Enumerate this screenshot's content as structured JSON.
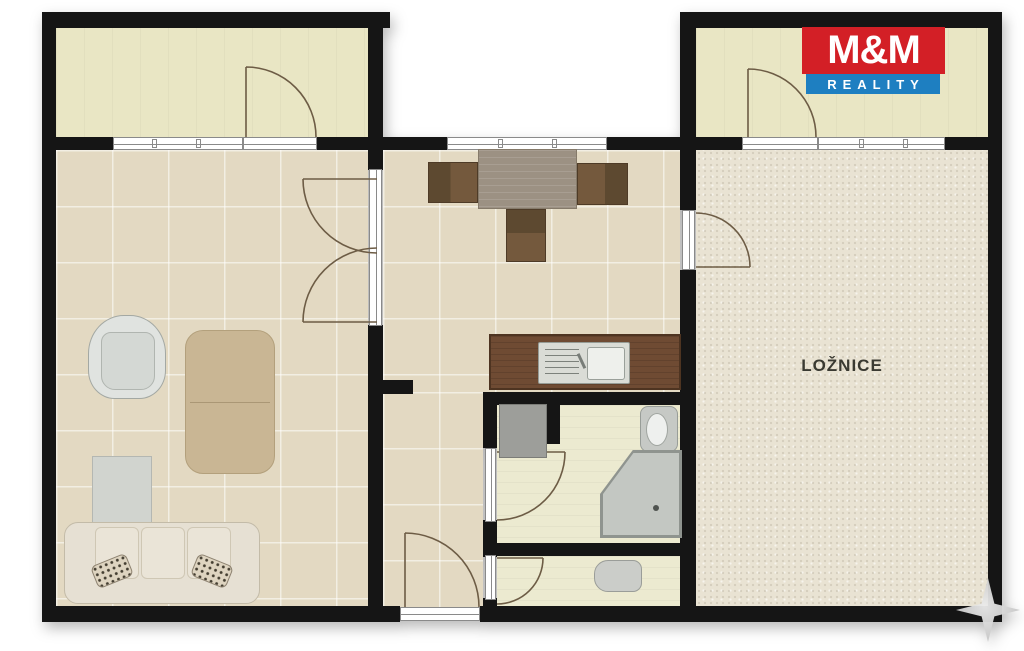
{
  "logo": {
    "line1": "M&M",
    "line2": "REALITY",
    "colors": {
      "line1_bg": "#d31f26",
      "line2_bg": "#1e7fc1",
      "text": "#ffffff"
    }
  },
  "bedroom": {
    "label": "LOŽNICE"
  },
  "palette": {
    "wall": "#151515",
    "tile_floor": "#e3d9c2",
    "balcony_floor": "#e9e6c4",
    "bath_floor": "#ecead0",
    "bedroom_floor": "#e9e3d3",
    "kitchen_counter": "#6f4b33",
    "door_swing_line": "#6d5c45",
    "ornament_star": "#c4c4c4"
  },
  "furniture_icons": [
    "sofa",
    "leopard-pillow",
    "armchair",
    "coffee-table",
    "tv-board",
    "dining-table",
    "dining-chair",
    "kitchen-counter",
    "kitchen-sink",
    "washing-machine",
    "corner-bathtub",
    "wash-basin",
    "toilet"
  ]
}
